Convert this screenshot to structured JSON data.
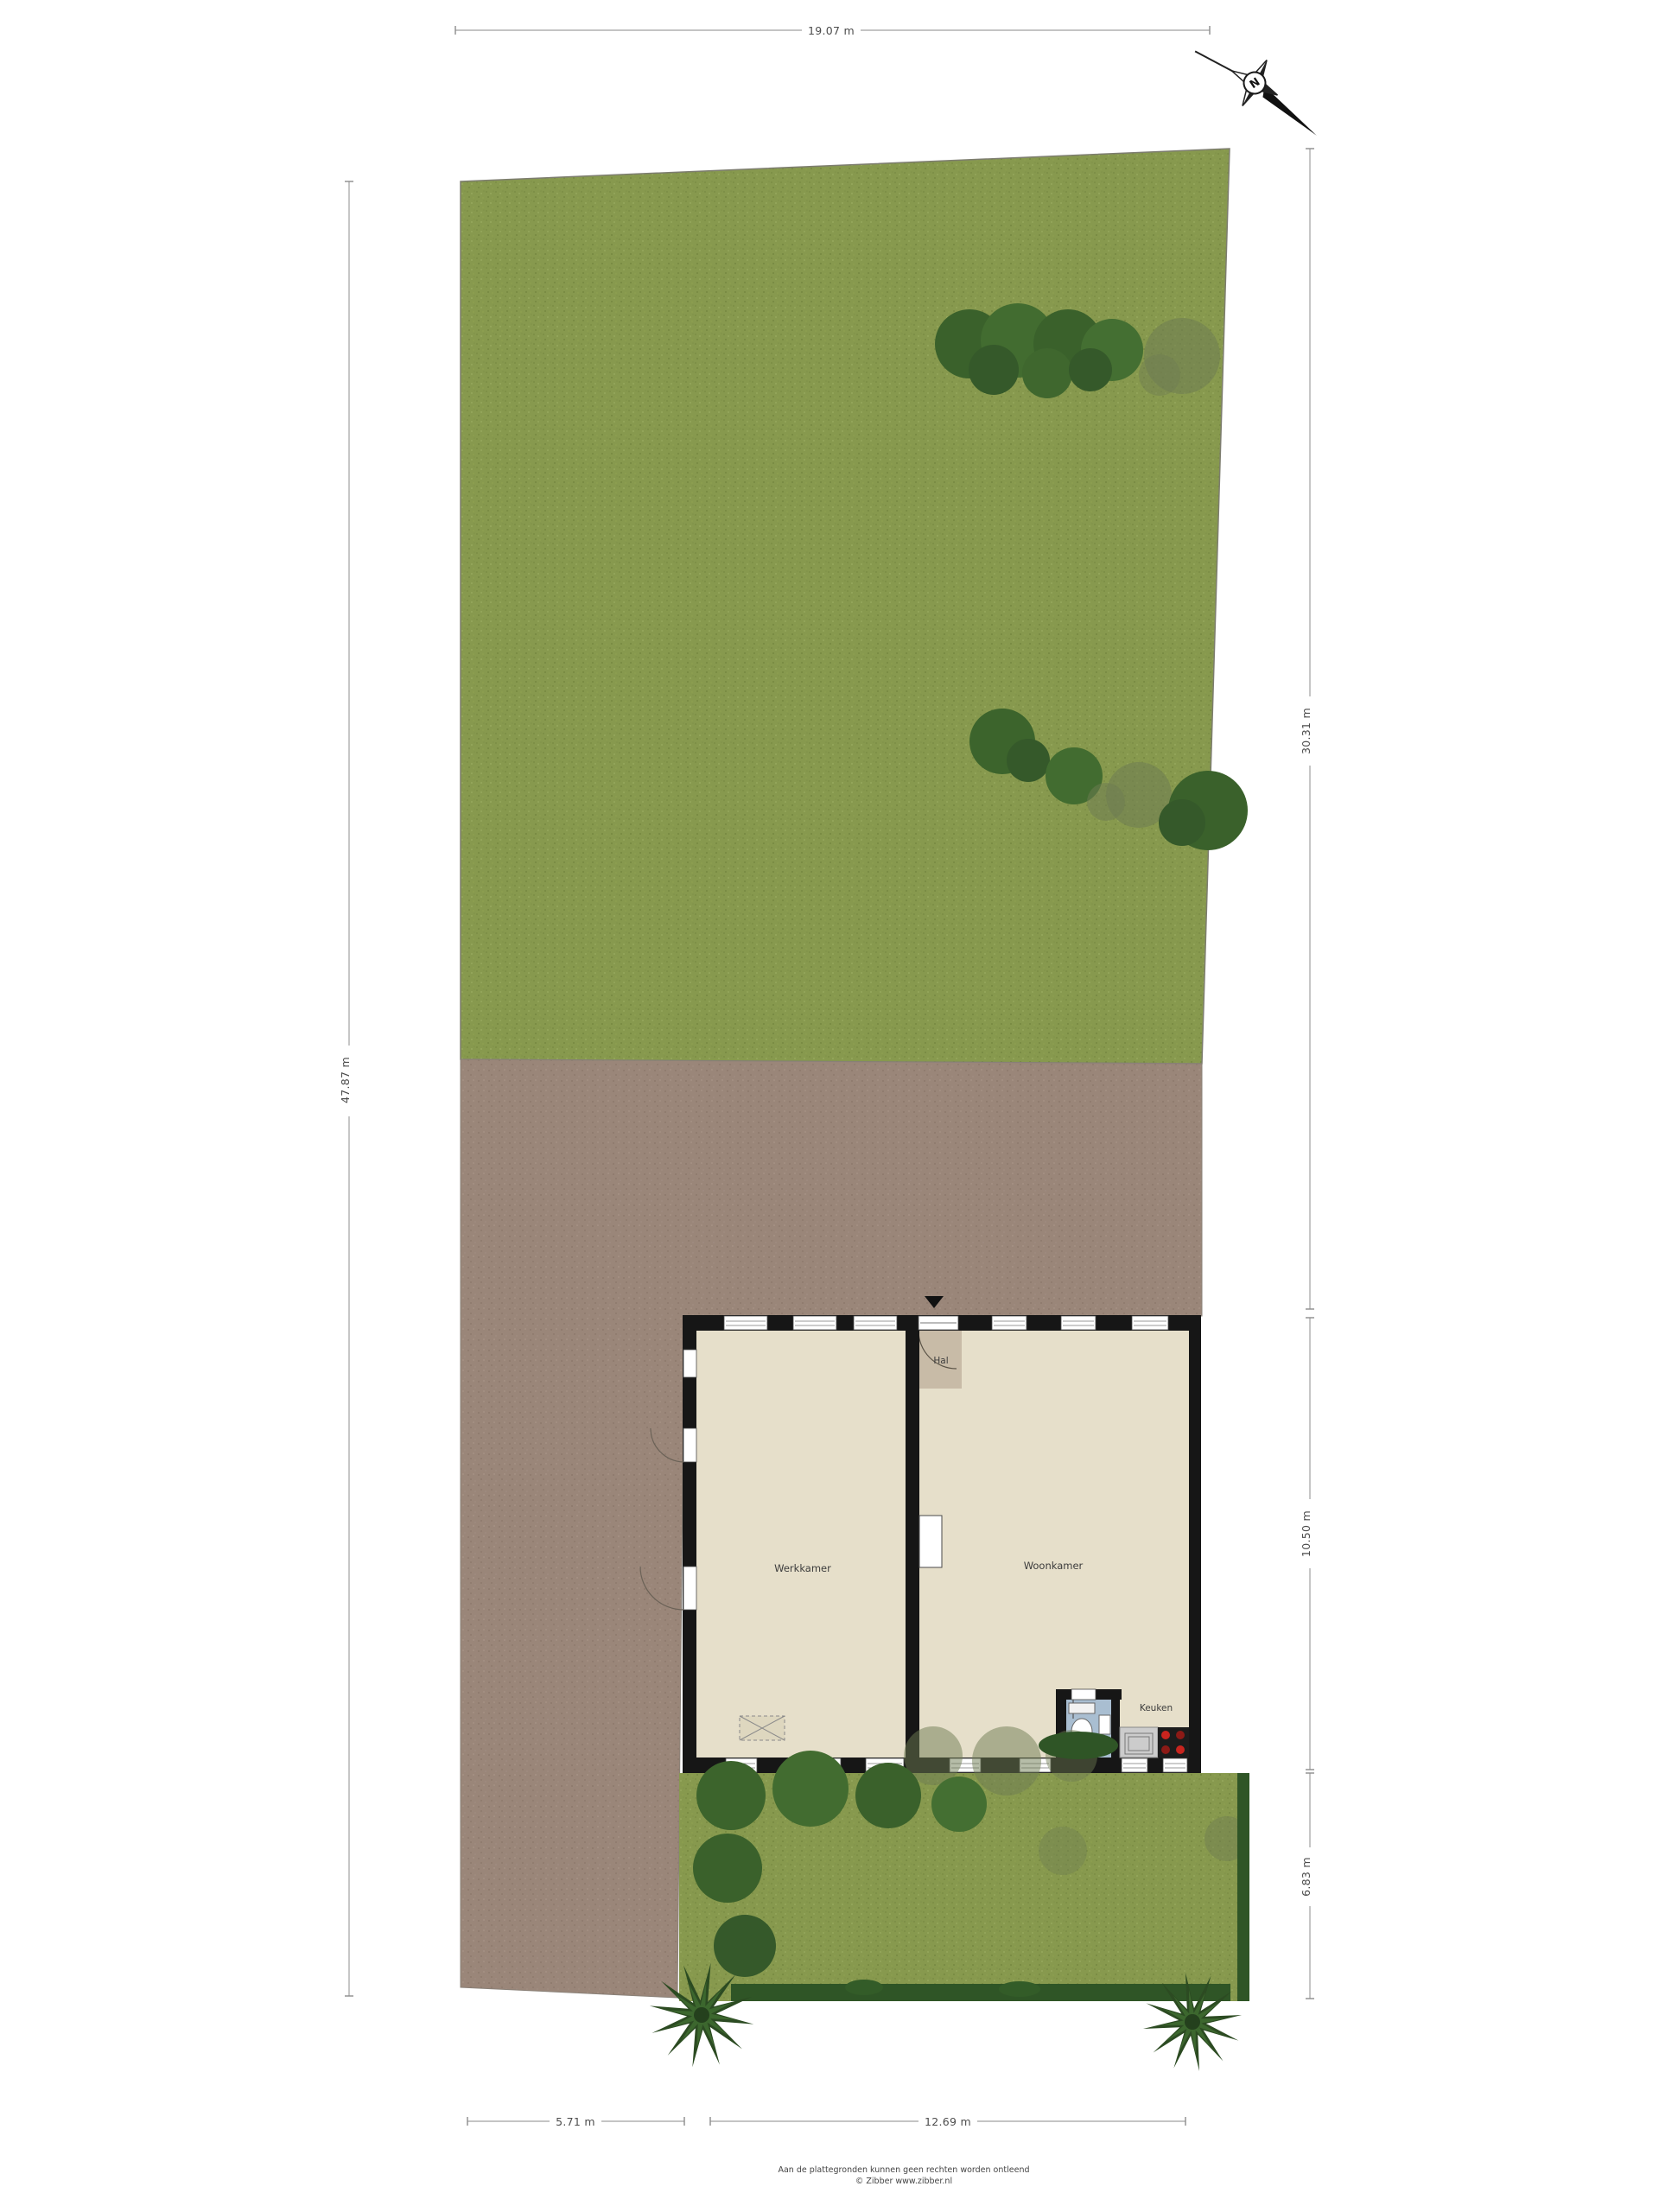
{
  "compass": {
    "label": "N"
  },
  "dimensions": {
    "top": "19.07 m",
    "left": "47.87 m",
    "right_upper": "30.31 m",
    "right_middle": "10.50 m",
    "right_lower": "6.83 m",
    "bottom_left": "5.71 m",
    "bottom_right": "12.69 m"
  },
  "rooms": {
    "werkkamer": "Werkkamer",
    "woonkamer": "Woonkamer",
    "hal": "Hal",
    "keuken": "Keuken"
  },
  "footer": {
    "disclaimer": "Aan de plattegronden kunnen geen rechten worden ontleend",
    "credit": "© Zibber www.zibber.nl"
  },
  "colors": {
    "grass": "#87994e",
    "paving": "#9a8679",
    "floor": "#e6dfca",
    "hal_floor": "#c8bba7",
    "wall": "#161616",
    "hedge": "#2f5526",
    "tree_dark": "#3c642c",
    "toilet_floor": "#a9bed1"
  }
}
